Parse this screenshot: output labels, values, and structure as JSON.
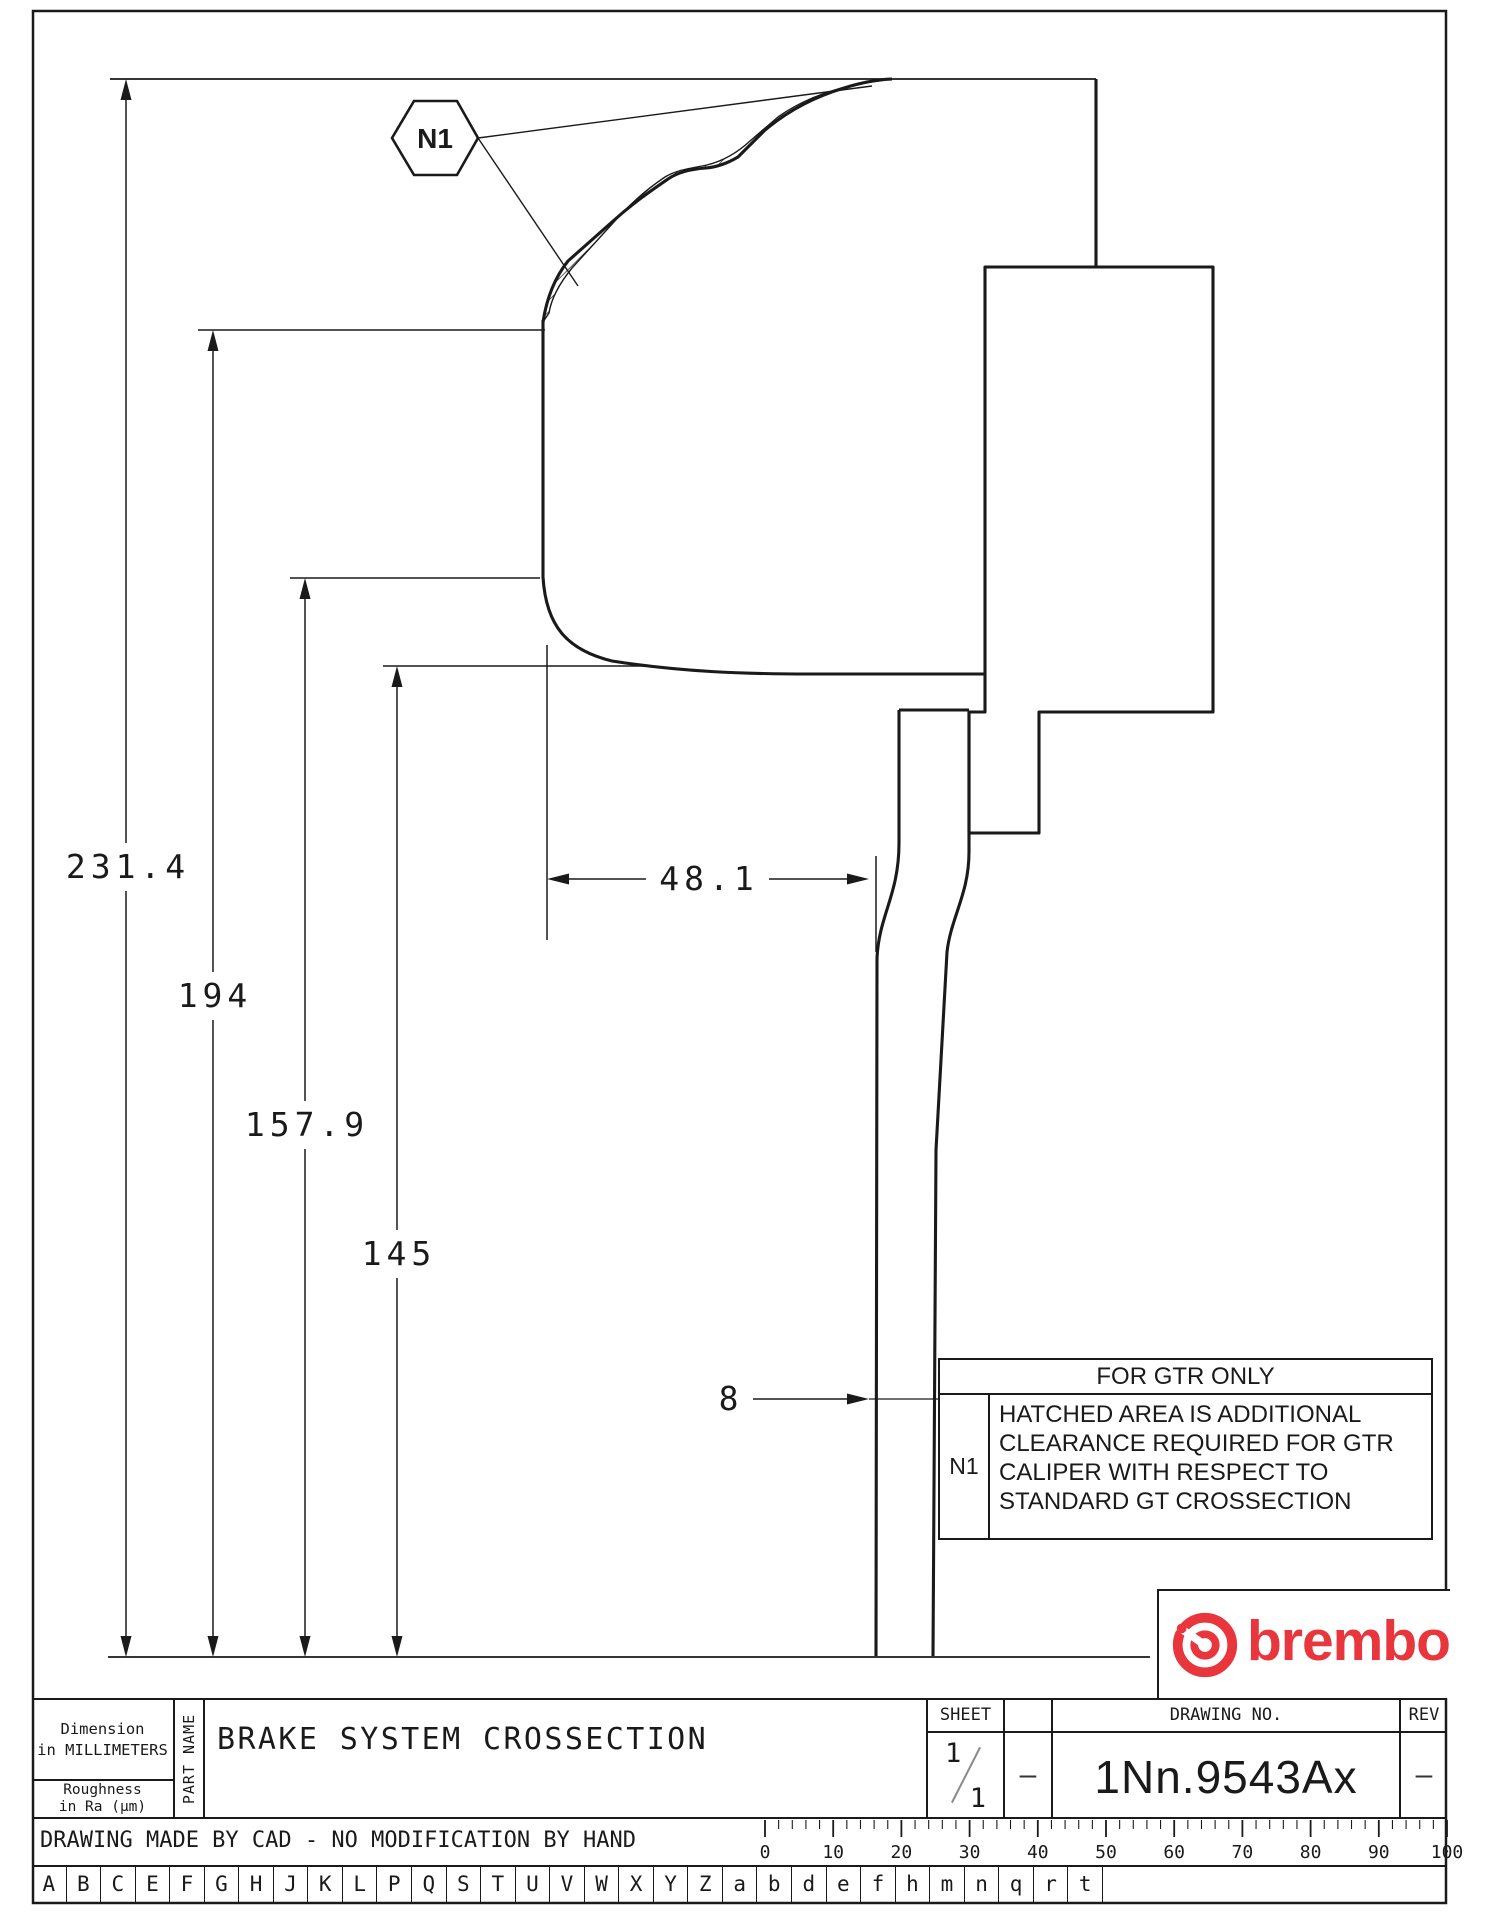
{
  "page": {
    "bg": "#ffffff",
    "ink": "#1a1a1a",
    "brand_red": "#e8363c"
  },
  "drawing": {
    "dim_radius_1": "231.4",
    "dim_radius_2": "194",
    "dim_radius_3": "157.9",
    "dim_radius_4": "145",
    "dim_width": "48.1",
    "dim_disc_thickness": "8",
    "callout_label": "N1"
  },
  "note_box": {
    "header": "FOR GTR ONLY",
    "ref_label": "N1",
    "line1": "HATCHED AREA IS ADDITIONAL",
    "line2": "CLEARANCE REQUIRED FOR GTR",
    "line3": "CALIPER WITH RESPECT TO",
    "line4": "STANDARD GT CROSSECTION"
  },
  "logo": {
    "wordmark": "brembo"
  },
  "titleblock": {
    "dimension_line1": "Dimension",
    "dimension_line2": "in MILLIMETERS",
    "roughness_line1": "Roughness",
    "roughness_line2": "in Ra (μm)",
    "part_name_label": "PART NAME",
    "part_name_value": "BRAKE SYSTEM CROSSECTION",
    "sheet_label": "SHEET",
    "sheet_numerator": "1",
    "sheet_denominator": "1",
    "between_dash": "–",
    "drawing_no_label": "DRAWING NO.",
    "drawing_no_value": "1Nn.9543Ax",
    "rev_label": "REV",
    "rev_value": "–",
    "cad_note": "DRAWING MADE BY CAD - NO MODIFICATION BY HAND"
  },
  "ruler": {
    "labels": [
      "0",
      "10",
      "20",
      "30",
      "40",
      "50",
      "60",
      "70",
      "80",
      "90",
      "100"
    ]
  },
  "letter_row": [
    "A",
    "B",
    "C",
    "E",
    "F",
    "G",
    "H",
    "J",
    "K",
    "L",
    "P",
    "Q",
    "S",
    "T",
    "U",
    "V",
    "W",
    "X",
    "Y",
    "Z",
    "a",
    "b",
    "d",
    "e",
    "f",
    "h",
    "m",
    "n",
    "q",
    "r",
    "t"
  ]
}
